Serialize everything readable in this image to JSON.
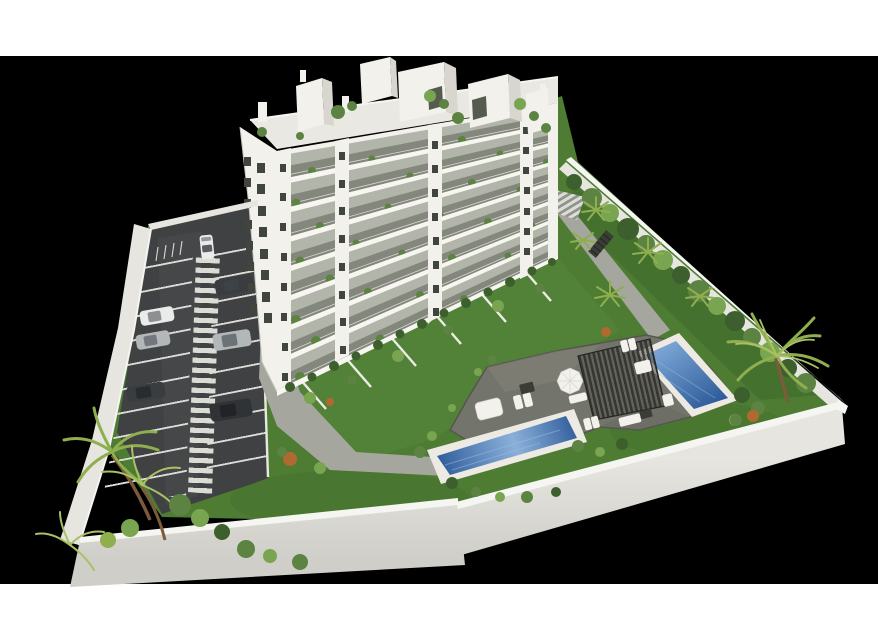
{
  "meta": {
    "kind": "3d-architectural-render",
    "description": "Aerial 3D rendering of a white 8-storey apartment building with balconies, a walled site containing a parking lot with marked bays and a striped pedestrian walkway, landscaped gardens with palm trees and hedges, a grey stone leisure deck with pergola, sun loungers and two rectangular swimming pools. Scene sits on a black backdrop with white letterbox bands top and bottom.",
    "no_text_present": true
  },
  "canvas": {
    "width": 878,
    "height": 640,
    "letterbox_top_height": 56,
    "letterbox_bottom_start": 584
  },
  "scene": {
    "building_floors_visible": 8,
    "swimming_pools": 2,
    "parked_cars": 7,
    "labels": [
      "apartment-building",
      "roof-boxes",
      "balconies",
      "gable-windows",
      "parking-lot",
      "pedestrian-walkway",
      "parking-cars",
      "perimeter-walls",
      "garden-lawn",
      "palm-trees",
      "hedge-row",
      "pool-deck",
      "pergola",
      "sun-loungers",
      "parasol",
      "pool-1",
      "pool-2",
      "garden-paths",
      "crosswalk",
      "outdoor-stair"
    ]
  },
  "palette": {
    "page_white": "#ffffff",
    "backdrop_black": "#000000",
    "lawn": "#4e7c33",
    "lawn_light": "#5d9040",
    "lawn_dark": "#3c6428",
    "asphalt": "#3f4143",
    "asphalt_light": "#4d5053",
    "line_white": "#dcdcd6",
    "wall_top": "#f5f5f1",
    "wall_face": "#e6e5e0",
    "wall_face_dark": "#cfcec8",
    "building_white": "#f2f1eb",
    "building_shade": "#d8d6cf",
    "slab_white": "#f7f6f1",
    "recess": "#b2b5a9",
    "glass_dark": "#565b50",
    "window_dark": "#40453e",
    "roof_surface": "#e9e8e2",
    "plant_green": "#5c8342",
    "plant_light": "#79a551",
    "hedge_dark": "#3c5f2d",
    "palm_green": "#8fae4e",
    "palm_light": "#a9c266",
    "trunk_brown": "#7b5b3b",
    "path_gray": "#a5a69e",
    "deck_gray": "#73746b",
    "deck_edge": "#55564f",
    "coping_white": "#eceae3",
    "water_light": "#7fa9d8",
    "water_deep": "#2e5b9a",
    "pergola_dark": "#2e2f2b",
    "furniture_white": "#f2f1ec",
    "furniture_dark": "#3b3c36",
    "car_white": "#eaecec",
    "car_silver": "#b2b7ba",
    "car_dark": "#3a3d40",
    "car_black": "#303336",
    "car_glass": "#3f444a",
    "flower_orange": "#b06a30"
  }
}
